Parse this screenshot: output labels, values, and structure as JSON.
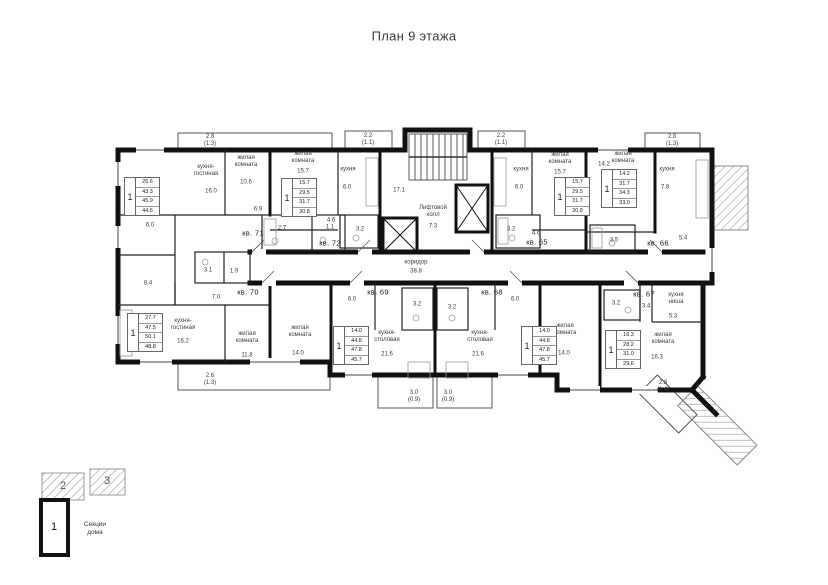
{
  "plan": {
    "title": "План 9 этажа",
    "apartments": {
      "kv71": {
        "label": "кв. 71",
        "num": "1",
        "areas": [
          "26.6",
          "43.3",
          "45.9",
          "44.6"
        ]
      },
      "kv72": {
        "label": "кв. 72",
        "num": "1",
        "areas": [
          "15.7",
          "29.5",
          "31.7",
          "30.8"
        ]
      },
      "kv65": {
        "label": "кв. 65",
        "num": "1",
        "areas": [
          "15.7",
          "29.5",
          "31.7",
          "30.8"
        ]
      },
      "kv66": {
        "label": "кв. 66",
        "num": "1",
        "areas": [
          "14.2",
          "31.7",
          "34.3",
          "33.0"
        ]
      },
      "kv70": {
        "label": "кв. 70",
        "num": "1",
        "areas": [
          "27.7",
          "47.5",
          "50.1",
          "48.8"
        ]
      },
      "kv69": {
        "label": "кв. 69",
        "num": "1",
        "areas": [
          "14.0",
          "44.8",
          "47.8",
          "45.7"
        ]
      },
      "kv68": {
        "label": "кв. 68",
        "num": "1",
        "areas": [
          "14.0",
          "44.8",
          "47.8",
          "45.7"
        ]
      },
      "kv67": {
        "label": "кв. 67",
        "num": "1",
        "areas": [
          "16.3",
          "28.2",
          "31.0",
          "29.6"
        ]
      }
    },
    "labels": [
      {
        "n": "balcony-area-top-left",
        "t": "2.8\n(1.3)",
        "x": 210,
        "y": 141
      },
      {
        "n": "balcony-area-top-kv72",
        "t": "2.2\n(1.1)",
        "x": 368,
        "y": 140
      },
      {
        "n": "balcony-area-top-kv65",
        "t": "2.2\n(1.1)",
        "x": 501,
        "y": 140
      },
      {
        "n": "balcony-area-top-right",
        "t": "2.8\n(1.3)",
        "x": 672,
        "y": 141
      },
      {
        "n": "kv71-kitchen-living",
        "t": "кухня-\nгостиная",
        "x": 206,
        "y": 171
      },
      {
        "n": "kv71-kitchen-living-area",
        "t": "16.0",
        "x": 211,
        "y": 192
      },
      {
        "n": "kv71-living-room",
        "t": "жилая\nкомната",
        "x": 246,
        "y": 162
      },
      {
        "n": "kv71-living-area",
        "t": "10.6",
        "x": 246,
        "y": 183
      },
      {
        "n": "kv71-hall-area",
        "t": "6.9",
        "x": 258,
        "y": 210
      },
      {
        "n": "kv71-room-area",
        "t": "6.0",
        "x": 150,
        "y": 226
      },
      {
        "n": "kv71-bath-area",
        "t": "2.7",
        "x": 282,
        "y": 229
      },
      {
        "n": "kv71-wc-area",
        "t": "1.1",
        "x": 330,
        "y": 228
      },
      {
        "n": "kv70-hall2-area",
        "t": "8.4",
        "x": 148,
        "y": 284
      },
      {
        "n": "kv72-living-room",
        "t": "жилая\nкомната",
        "x": 303,
        "y": 158
      },
      {
        "n": "kv72-living-area",
        "t": "15.7",
        "x": 303,
        "y": 172
      },
      {
        "n": "kv72-kitchen",
        "t": "кухня",
        "x": 348,
        "y": 170
      },
      {
        "n": "kv72-kitchen-area",
        "t": "6.0",
        "x": 347,
        "y": 188
      },
      {
        "n": "kv72-hall-area",
        "t": "4.6",
        "x": 331,
        "y": 221
      },
      {
        "n": "kv72-bath-area",
        "t": "3.2",
        "x": 360,
        "y": 230
      },
      {
        "n": "core-stair-hall-area",
        "t": "17.1",
        "x": 399,
        "y": 191
      },
      {
        "n": "core-elevator-hall",
        "t": "Лифтовой\nхолл",
        "x": 433,
        "y": 212
      },
      {
        "n": "core-elevator-hall-area",
        "t": "7.3",
        "x": 433,
        "y": 227
      },
      {
        "n": "core-corridor",
        "t": "коридор",
        "x": 416,
        "y": 263
      },
      {
        "n": "core-corridor-area",
        "t": "38.8",
        "x": 416,
        "y": 272
      },
      {
        "n": "kv65-kitchen",
        "t": "кухня",
        "x": 521,
        "y": 170
      },
      {
        "n": "kv65-kitchen-area",
        "t": "6.0",
        "x": 519,
        "y": 188
      },
      {
        "n": "kv65-living-room",
        "t": "жилая\nкомната",
        "x": 560,
        "y": 159
      },
      {
        "n": "kv65-living-area",
        "t": "15.7",
        "x": 560,
        "y": 173
      },
      {
        "n": "kv65-hall-area",
        "t": "4.6",
        "x": 536,
        "y": 234
      },
      {
        "n": "kv65-bath-area",
        "t": "3.2",
        "x": 511,
        "y": 230
      },
      {
        "n": "kv66-living-room",
        "t": "жилая\nкомната",
        "x": 623,
        "y": 158
      },
      {
        "n": "kv66-living-area",
        "t": "14.2",
        "x": 604,
        "y": 165
      },
      {
        "n": "kv66-kitchen",
        "t": "кухня",
        "x": 667,
        "y": 170
      },
      {
        "n": "kv66-kitchen-area",
        "t": "7.8",
        "x": 665,
        "y": 188
      },
      {
        "n": "kv66-bath-area",
        "t": "3.5",
        "x": 614,
        "y": 241
      },
      {
        "n": "kv66-hall-area",
        "t": "5.4",
        "x": 683,
        "y": 239
      },
      {
        "n": "kv70-hall-area",
        "t": "7.0",
        "x": 216,
        "y": 298
      },
      {
        "n": "kv70-kitchen-living",
        "t": "кухня-\nгостиная",
        "x": 183,
        "y": 325
      },
      {
        "n": "kv70-kitchen-living-area",
        "t": "16.2",
        "x": 183,
        "y": 342
      },
      {
        "n": "kv70-living-room",
        "t": "жилая\nкомната",
        "x": 247,
        "y": 338
      },
      {
        "n": "kv70-living-area",
        "t": "11.8",
        "x": 247,
        "y": 356
      },
      {
        "n": "kv70-bath-area",
        "t": "3.1",
        "x": 208,
        "y": 271
      },
      {
        "n": "kv70-wc-area",
        "t": "1.9",
        "x": 234,
        "y": 272
      },
      {
        "n": "kv69-living-room",
        "t": "жилая\nкомната",
        "x": 300,
        "y": 332
      },
      {
        "n": "kv69-living-area",
        "t": "14.0",
        "x": 298,
        "y": 354
      },
      {
        "n": "kv69-kitchen-dining",
        "t": "кухня-\nстоловая",
        "x": 387,
        "y": 337
      },
      {
        "n": "kv69-kitchen-dining-area",
        "t": "21.6",
        "x": 387,
        "y": 355
      },
      {
        "n": "kv69-hall-area",
        "t": "6.0",
        "x": 352,
        "y": 300
      },
      {
        "n": "kv69-bath-area",
        "t": "3.2",
        "x": 417,
        "y": 305
      },
      {
        "n": "kv68-living-room",
        "t": "жилая\nкомната",
        "x": 565,
        "y": 330
      },
      {
        "n": "kv68-living-area",
        "t": "14.0",
        "x": 564,
        "y": 354
      },
      {
        "n": "kv68-kitchen-dining",
        "t": "кухня-\nстоловая",
        "x": 480,
        "y": 337
      },
      {
        "n": "kv68-kitchen-dining-area",
        "t": "21.6",
        "x": 478,
        "y": 355
      },
      {
        "n": "kv68-hall-area",
        "t": "6.0",
        "x": 515,
        "y": 300
      },
      {
        "n": "kv68-bath-area",
        "t": "3.2",
        "x": 452,
        "y": 308
      },
      {
        "n": "kv67-bath-area",
        "t": "3.2",
        "x": 616,
        "y": 304
      },
      {
        "n": "kv67-hall-area",
        "t": "3.4",
        "x": 646,
        "y": 307
      },
      {
        "n": "kv67-kitchen-niche",
        "t": "кухня\nниша",
        "x": 676,
        "y": 299
      },
      {
        "n": "kv67-kitchen-niche-area",
        "t": "5.3",
        "x": 673,
        "y": 317
      },
      {
        "n": "kv67-living-room",
        "t": "жилая\nкомната",
        "x": 663,
        "y": 339
      },
      {
        "n": "kv67-living-area",
        "t": "16.3",
        "x": 657,
        "y": 358
      },
      {
        "n": "balcony-area-bottom-left",
        "t": "2.6\n(1.3)",
        "x": 210,
        "y": 380
      },
      {
        "n": "balcony-area-bottom-kv69",
        "t": "3.0\n(0.9)",
        "x": 414,
        "y": 397
      },
      {
        "n": "balcony-area-bottom-kv68",
        "t": "3.0\n(0.9)",
        "x": 448,
        "y": 397
      },
      {
        "n": "balcony-area-bottom-right",
        "t": "2.8\n(1.4)",
        "x": 663,
        "y": 387
      }
    ],
    "legend": {
      "caption": "Секции\nдома",
      "s1": "1",
      "s2": "2",
      "s3": "3"
    }
  }
}
